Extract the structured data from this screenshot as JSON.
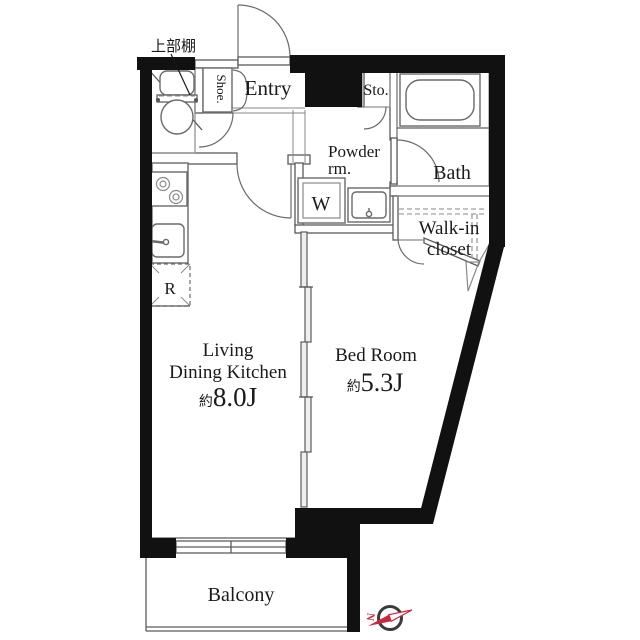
{
  "floorplan": {
    "rooms": {
      "entry": "Entry",
      "shoe": "Shoe.",
      "storage": "Sto.",
      "bath": "Bath",
      "powder_room": [
        "Powder",
        "rm."
      ],
      "walk_in_closet": [
        "Walk-in",
        "closet"
      ],
      "washer": "W",
      "fridge": "R",
      "ldk": {
        "name_line1": "Living",
        "name_line2": "Dining Kitchen",
        "size_prefix": "約",
        "size": "8.0J"
      },
      "bedroom": {
        "name": "Bed Room",
        "size_prefix": "約",
        "size": "5.3J"
      },
      "balcony": "Balcony"
    },
    "annotations": {
      "upper_shelf": "上部棚",
      "compass_north": "N"
    },
    "colors": {
      "wall": "#111111",
      "line": "#5a5a5a",
      "compass_red": "#c9283f",
      "text": "#1a1a1a",
      "background": "#ffffff"
    }
  }
}
